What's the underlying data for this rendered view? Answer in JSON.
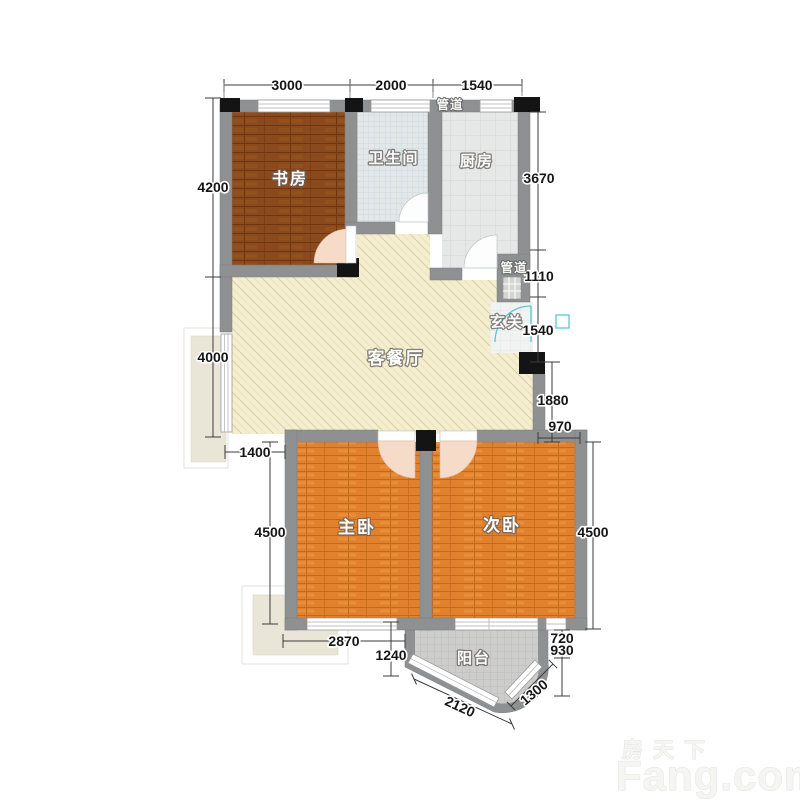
{
  "plan": {
    "rooms": {
      "study": "书房",
      "bathroom": "卫生间",
      "kitchen": "厨房",
      "living": "客餐厅",
      "entry": "玄关",
      "master": "主卧",
      "second": "次卧",
      "balcony": "阳台"
    },
    "ducts": {
      "top": "管道",
      "side": "管道"
    },
    "dims": {
      "top": [
        "3000",
        "2000",
        "1540"
      ],
      "left": [
        "4200",
        "4000"
      ],
      "left_lower": {
        "offset": "1400",
        "height": "4500"
      },
      "right": [
        "3670",
        "1110",
        "1540",
        "1880",
        "970",
        "4500",
        "720",
        "930"
      ],
      "bottom": [
        "2870",
        "1240",
        "2120",
        "1300"
      ]
    },
    "colors": {
      "wall": "#8f9092",
      "study_floor": "#8b4a1d",
      "bedroom_floor": "#e1812e",
      "living_floor": "#f4eecf",
      "entry_door_accent": "#57c8d6"
    }
  },
  "watermark": {
    "cn": "房天下",
    "en": "Fang.com"
  }
}
